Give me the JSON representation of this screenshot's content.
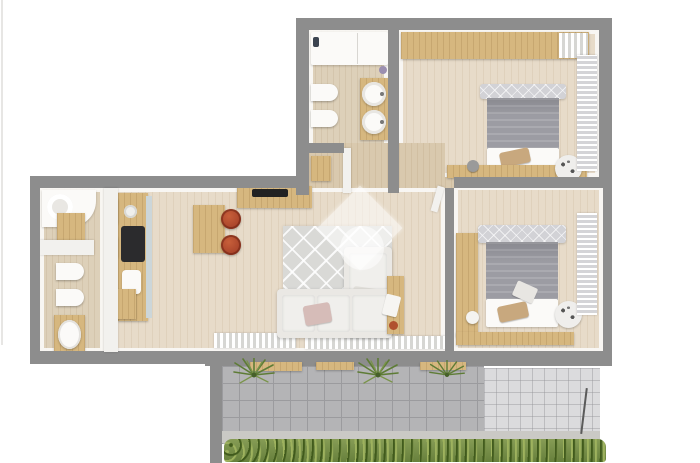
{
  "scene": {
    "kind": "3d-apartment-floor-plan-top-view",
    "watermark_shape": "diamond-house-logo-with-circle"
  },
  "palette": {
    "wall_gray": "#8d8d8d",
    "floor_wood": "#e7dbc9",
    "floor_bath": "#ddd0b9",
    "floor_hall": "#d9c9ae",
    "wood": "#d6b77f",
    "blanket_gray": "#9c9ca3",
    "headboard_gray": "#d2d2d6",
    "sofa_white": "#eae8e4",
    "rug_gray": "#d9d9d6",
    "stool_red": "#a8432a",
    "cooktop_black": "#2b2b2d",
    "fixture_white": "#fbfaf8",
    "tile_gray": "#b4b4b6",
    "tile_grout": "#9b9b9e",
    "tile_light": "#dbdbdd",
    "concrete": "#cac9c5",
    "hedge_green": "#869c55",
    "palm_green": "#5e7c36",
    "backsplash_blue": "#ccd6d9",
    "pillow_tan": "#c8a87e",
    "pillow_blush": "#d6bcb8"
  },
  "rooms": [
    {
      "id": "bathroom-top",
      "label": "Bathroom 1",
      "furniture": [
        "shower",
        "toilet",
        "bidet",
        "double-sink-counter"
      ]
    },
    {
      "id": "bedroom-1",
      "label": "Bedroom 1",
      "furniture": [
        "wardrobe",
        "double-bed",
        "desk",
        "round-rug",
        "curtains"
      ]
    },
    {
      "id": "hallway",
      "label": "Hallway",
      "furniture": [
        "cabinet"
      ]
    },
    {
      "id": "bathroom-left",
      "label": "Bathroom 2",
      "furniture": [
        "shower",
        "cabinet",
        "toilet",
        "bidet",
        "vanity-sink"
      ]
    },
    {
      "id": "kitchen",
      "label": "Kitchen",
      "furniture": [
        "counter",
        "cooktop",
        "sink",
        "island",
        "bar-stools"
      ]
    },
    {
      "id": "living-room",
      "label": "Living Room",
      "furniture": [
        "tv-sideboard",
        "corner-sofa",
        "patterned-rug",
        "side-table",
        "radiators"
      ]
    },
    {
      "id": "bedroom-2",
      "label": "Bedroom 2",
      "furniture": [
        "wardrobe",
        "double-bed",
        "bench",
        "round-rug",
        "louver-curtain"
      ]
    },
    {
      "id": "balcony",
      "label": "Balcony",
      "furniture": [
        "planter-benches",
        "palm-plants",
        "hedge",
        "railing"
      ]
    }
  ]
}
